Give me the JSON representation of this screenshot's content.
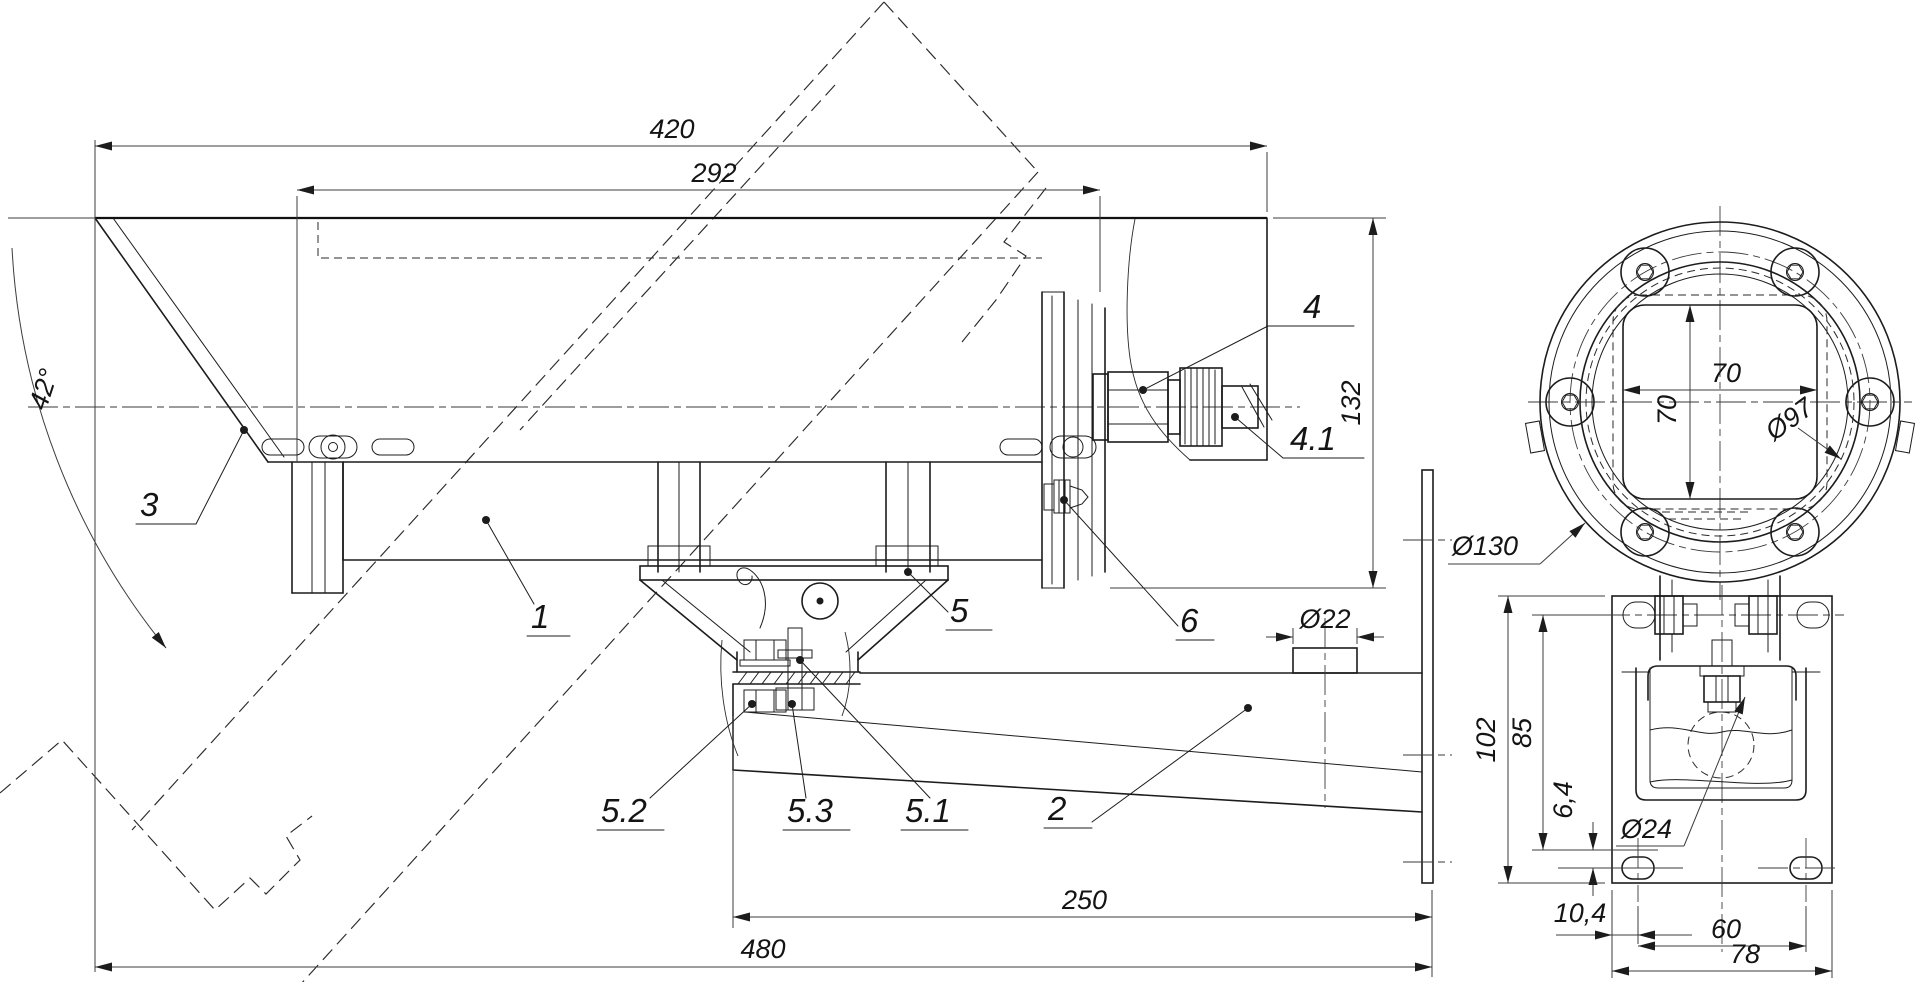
{
  "drawing_type": "camera-housing-outline-drawing",
  "dimensions": {
    "overall_length": "480",
    "arm_pivot_to_plate": "250",
    "housing_length": "420",
    "shield_rear_length": "292",
    "shield_tilt_angle": "42°",
    "rear_height": "132",
    "cable_gland_dia": "Ø22",
    "flange_dia": "Ø130",
    "bezel_dia": "Ø97",
    "window_width": "70",
    "window_height": "70",
    "plate_height": "102",
    "bolt_to_slot": "85",
    "slot_offset": "6,4",
    "clamp_hole_dia": "Ø24",
    "slot_edge_offset": "10,4",
    "slot_spacing": "60",
    "plate_width": "78"
  },
  "part_labels": {
    "housing": "1",
    "bracket_arm": "2",
    "sun_shield": "3",
    "connector": "4",
    "connector_plug": "4.1",
    "cradle": "5",
    "pivot_stud": "5.1",
    "pivot_bolt": "5.2",
    "pivot_nut": "5.3",
    "ground_screw": "6"
  }
}
